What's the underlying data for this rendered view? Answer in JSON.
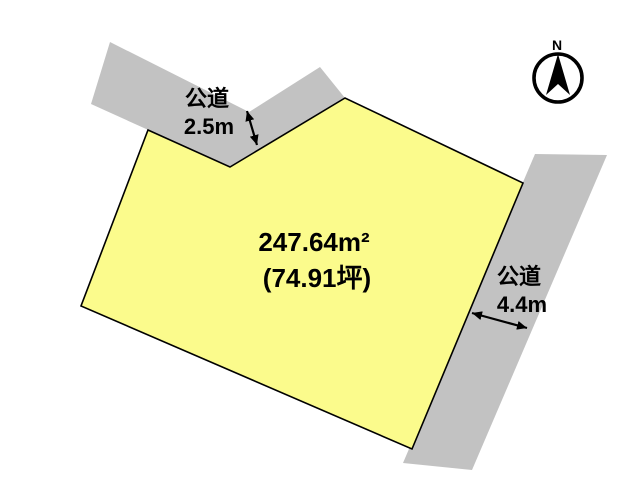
{
  "diagram": {
    "compass": {
      "north_label": "N"
    },
    "plot": {
      "area_m2": "247.64m²",
      "area_tsubo": "(74.91坪)"
    },
    "roads": {
      "top": {
        "name": "公道",
        "width": "2.5m"
      },
      "right": {
        "name": "公道",
        "width": "4.4m"
      }
    },
    "colors": {
      "background": "#FFFFFF",
      "plot_fill": "#FBFB8C",
      "plot_outline": "#000000",
      "road_fill": "#C2C2C2",
      "ink": "#000000"
    }
  }
}
